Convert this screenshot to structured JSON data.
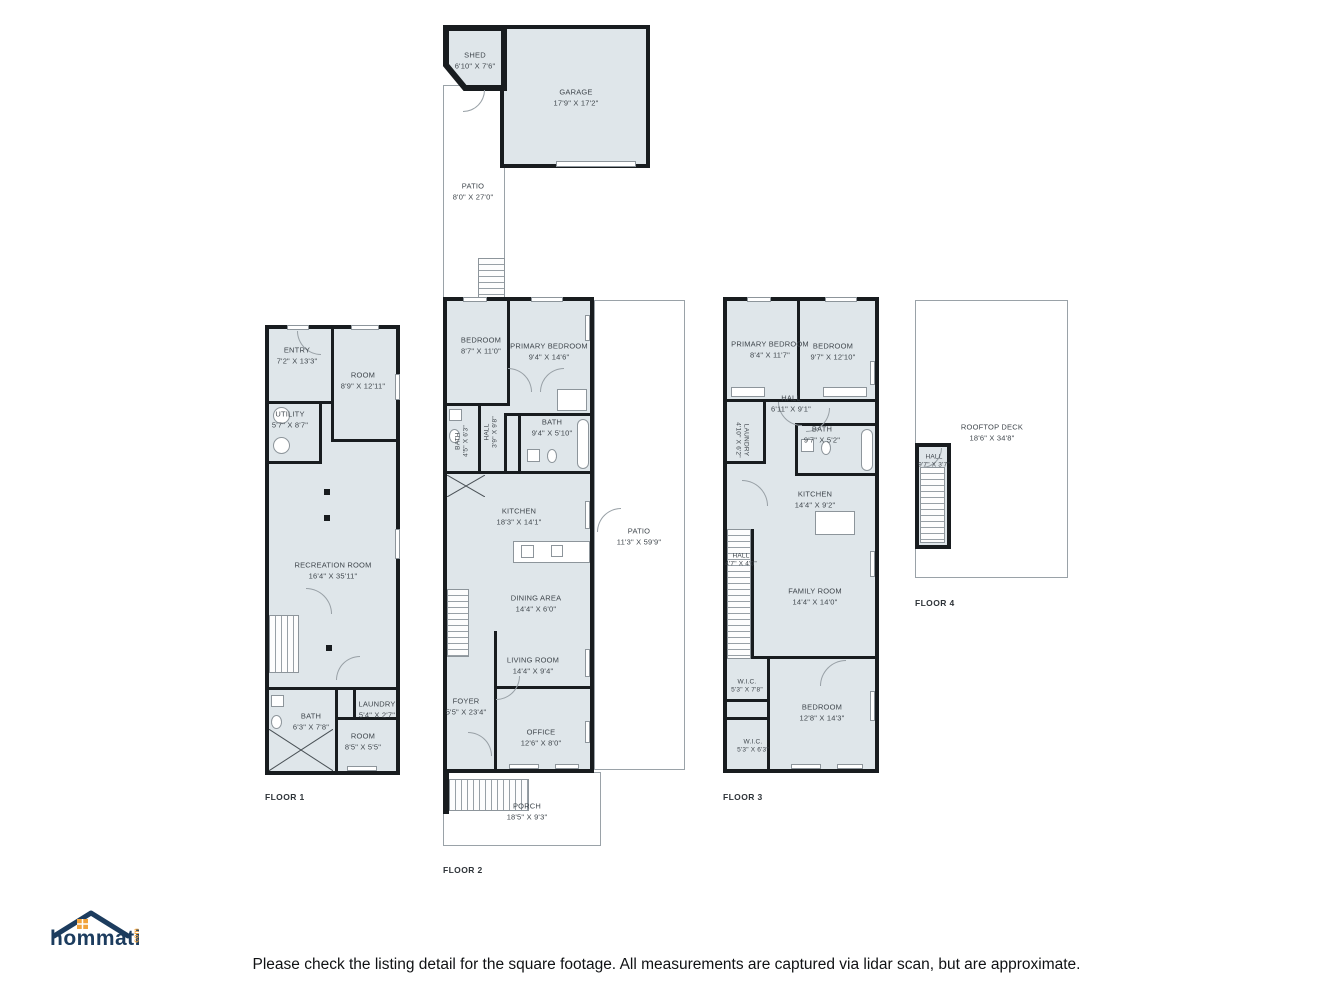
{
  "brand": {
    "name": "hommati",
    "suffix": "com"
  },
  "disclaimer": "Please check the listing detail for the square footage. All measurements are captured via lidar scan, but are approximate.",
  "colors": {
    "room_fill": "#dfe6ea",
    "wall": "#181c1f",
    "outline": "#9aa2a8",
    "logo_navy": "#1c3c5e",
    "logo_orange": "#f1a33c"
  },
  "outbuildings": {
    "shed": {
      "name": "SHED",
      "dims": "6'10\" X 7'6\""
    },
    "garage": {
      "name": "GARAGE",
      "dims": "17'9\" X 17'2\""
    },
    "patio": {
      "name": "PATIO",
      "dims": "8'0\" X 27'0\""
    }
  },
  "floor1": {
    "label": "FLOOR 1",
    "rooms": {
      "entry": {
        "name": "ENTRY",
        "dims": "7'2\" X 13'3\""
      },
      "room_top": {
        "name": "ROOM",
        "dims": "8'9\" X 12'11\""
      },
      "utility": {
        "name": "UTILITY",
        "dims": "5'7\" X 8'7\""
      },
      "recreation": {
        "name": "RECREATION ROOM",
        "dims": "16'4\" X 35'11\""
      },
      "bath": {
        "name": "BATH",
        "dims": "6'3\" X 7'8\""
      },
      "laundry": {
        "name": "LAUNDRY",
        "dims": "5'4\" X 2'7\""
      },
      "room_bottom": {
        "name": "ROOM",
        "dims": "8'5\" X 5'5\""
      }
    }
  },
  "floor2": {
    "label": "FLOOR 2",
    "rooms": {
      "bedroom": {
        "name": "BEDROOM",
        "dims": "8'7\" X 11'0\""
      },
      "primary": {
        "name": "PRIMARY BEDROOM",
        "dims": "9'4\" X 14'6\""
      },
      "bath_small": {
        "name": "BATH",
        "dims": "4'5\" X 6'3\""
      },
      "hall": {
        "name": "HALL",
        "dims": "3'9\" X 9'8\""
      },
      "bath": {
        "name": "BATH",
        "dims": "9'4\" X 5'10\""
      },
      "kitchen": {
        "name": "KITCHEN",
        "dims": "18'3\" X 14'1\""
      },
      "dining": {
        "name": "DINING AREA",
        "dims": "14'4\" X 6'0\""
      },
      "living": {
        "name": "LIVING ROOM",
        "dims": "14'4\" X 9'4\""
      },
      "foyer": {
        "name": "FOYER",
        "dims": "5'5\" X 23'4\""
      },
      "office": {
        "name": "OFFICE",
        "dims": "12'6\" X 8'0\""
      },
      "patio": {
        "name": "PATIO",
        "dims": "11'3\" X 59'9\""
      },
      "porch": {
        "name": "PORCH",
        "dims": "18'5\" X 9'3\""
      }
    }
  },
  "floor3": {
    "label": "FLOOR 3",
    "rooms": {
      "primary": {
        "name": "PRIMARY BEDROOM",
        "dims": "8'4\" X 11'7\""
      },
      "bedroom": {
        "name": "BEDROOM",
        "dims": "9'7\" X 12'10\""
      },
      "hall": {
        "name": "HALL",
        "dims": "6'11\" X 9'1\""
      },
      "laundry": {
        "name": "LAUNDRY",
        "dims": "4'10\" X 6'2\""
      },
      "bath": {
        "name": "BATH",
        "dims": "9'7\" X 5'2\""
      },
      "kitchen": {
        "name": "KITCHEN",
        "dims": "14'4\" X 9'2\""
      },
      "hall2": {
        "name": "HALL",
        "dims": "4'7\" X 4'0\""
      },
      "family": {
        "name": "FAMILY ROOM",
        "dims": "14'4\" X 14'0\""
      },
      "wic1": {
        "name": "W.I.C.",
        "dims": "5'3\" X 7'8\""
      },
      "bedroom2": {
        "name": "BEDROOM",
        "dims": "12'8\" X 14'3\""
      },
      "wic2": {
        "name": "W.I.C.",
        "dims": "5'3\" X 6'3\""
      }
    }
  },
  "floor4": {
    "label": "FLOOR 4",
    "rooms": {
      "deck": {
        "name": "ROOFTOP DECK",
        "dims": "18'6\" X 34'8\""
      },
      "hall": {
        "name": "HALL",
        "dims": "9'7\" X 3'7\""
      }
    }
  }
}
